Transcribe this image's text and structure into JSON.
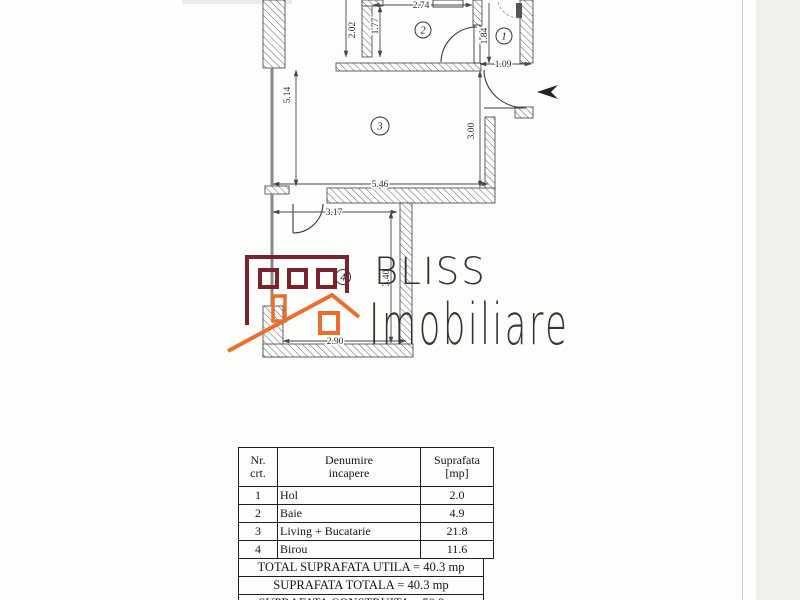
{
  "logo": {
    "brand_top": "BLISS",
    "brand_bottom": "Imobiliare",
    "maroon": "#7b2231",
    "orange": "#e8702c",
    "text_color": "#35342f"
  },
  "floor_plan": {
    "room_labels": [
      "1",
      "2",
      "3",
      "4"
    ],
    "dimensions": {
      "d274": "2.74",
      "d202": "2.02",
      "d177": "1.77",
      "d184": "1.84",
      "d109": "1.09",
      "d514": "5.14",
      "d300": "3.00",
      "d546": "5.46",
      "d317": "3.17",
      "d340": "3.40",
      "d290": "2.90"
    },
    "colors": {
      "wall_line": "#3d3d3d",
      "window_line": "#888888"
    }
  },
  "area_table": {
    "headers": {
      "c1": [
        "Nr.",
        "crt."
      ],
      "c2": [
        "Denumire",
        "incapere"
      ],
      "c3": [
        "Suprafata",
        "[mp]"
      ]
    },
    "rows": [
      {
        "nr": "1",
        "name": "Hol",
        "area": "2.0"
      },
      {
        "nr": "2",
        "name": "Baie",
        "area": "4.9"
      },
      {
        "nr": "3",
        "name": "Living + Bucatarie",
        "area": "21.8"
      },
      {
        "nr": "4",
        "name": "Birou",
        "area": "11.6"
      }
    ],
    "totals": [
      "TOTAL SUPRAFATA UTILA = 40.3 mp",
      "SUPRAFATA TOTALA = 40.3 mp",
      "SUPRAFATA CONSTRUITA = 50.9 mp"
    ]
  }
}
